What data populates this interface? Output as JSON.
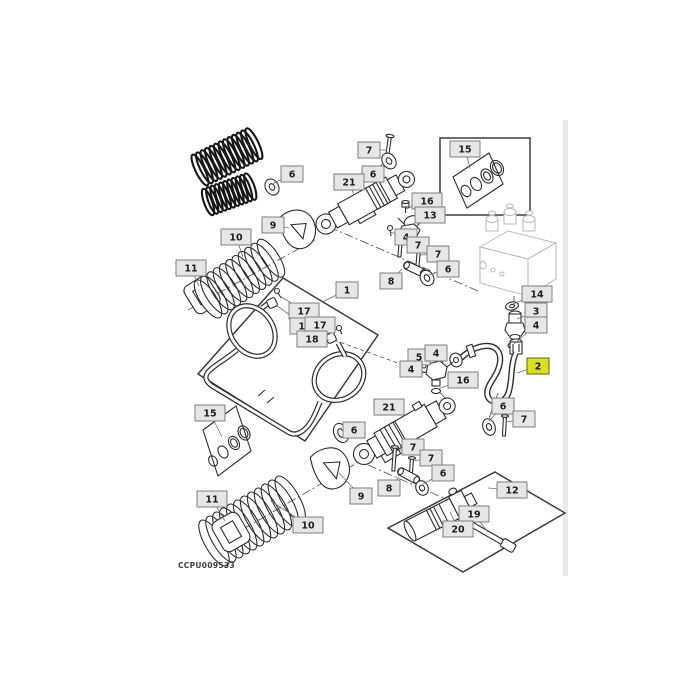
{
  "figure": {
    "caption": "CCPU009533",
    "selected_callout": "2",
    "label_fill": "#e6e6e6",
    "label_border": "#7f7f7f",
    "highlight_fill": "#d7e026",
    "highlight_border": "#5f6b00",
    "text_color": "#1d1d1d"
  },
  "callouts": [
    {
      "label": "7",
      "x": 358,
      "y": 142,
      "tx": 387,
      "ty": 150
    },
    {
      "label": "6",
      "x": 362,
      "y": 166,
      "tx": 383,
      "ty": 163
    },
    {
      "label": "21",
      "x": 334,
      "y": 174,
      "tx": 354,
      "ty": 195
    },
    {
      "label": "6",
      "x": 281,
      "y": 166,
      "tx": 272,
      "ty": 184
    },
    {
      "label": "9",
      "x": 262,
      "y": 217,
      "tx": 289,
      "ty": 228
    },
    {
      "label": "10",
      "x": 221,
      "y": 229,
      "tx": 243,
      "ty": 257
    },
    {
      "label": "11",
      "x": 176,
      "y": 260,
      "tx": 199,
      "ty": 286
    },
    {
      "label": "15",
      "x": 450,
      "y": 141,
      "tx": 470,
      "ty": 168
    },
    {
      "label": "16",
      "x": 412,
      "y": 193,
      "tx": 406,
      "ty": 209
    },
    {
      "label": "13",
      "x": 415,
      "y": 207,
      "tx": 417,
      "ty": 226
    },
    {
      "label": "4",
      "x": 395,
      "y": 229,
      "tx": 390,
      "ty": 232
    },
    {
      "label": "7",
      "x": 407,
      "y": 237,
      "tx": 401,
      "ty": 245
    },
    {
      "label": "7",
      "x": 427,
      "y": 246,
      "tx": 420,
      "ty": 255
    },
    {
      "label": "8",
      "x": 380,
      "y": 273,
      "tx": 402,
      "ty": 269
    },
    {
      "label": "6",
      "x": 437,
      "y": 261,
      "tx": 429,
      "ty": 275
    },
    {
      "label": "14",
      "x": 522,
      "y": 286,
      "tx": 513,
      "ty": 304
    },
    {
      "label": "3",
      "x": 525,
      "y": 303,
      "tx": 517,
      "ty": 319
    },
    {
      "label": "4",
      "x": 525,
      "y": 317,
      "tx": 514,
      "ty": 344
    },
    {
      "label": "2",
      "x": 527,
      "y": 358,
      "tx": 517,
      "ty": 373,
      "highlighted": true
    },
    {
      "label": "1",
      "x": 336,
      "y": 282,
      "tx": 322,
      "ty": 302
    },
    {
      "label": "17",
      "x": 289,
      "y": 303,
      "tx": 280,
      "ty": 296
    },
    {
      "label": "18",
      "x": 290,
      "y": 318,
      "tx": 276,
      "ty": 305
    },
    {
      "label": "17",
      "x": 305,
      "y": 317,
      "tx": 337,
      "ty": 330
    },
    {
      "label": "18",
      "x": 297,
      "y": 331,
      "tx": 329,
      "ty": 340
    },
    {
      "label": "15",
      "x": 195,
      "y": 405,
      "tx": 222,
      "ty": 437
    },
    {
      "label": "5",
      "x": 408,
      "y": 349,
      "tx": 427,
      "ty": 364
    },
    {
      "label": "4",
      "x": 425,
      "y": 345,
      "tx": 436,
      "ty": 355
    },
    {
      "label": "4",
      "x": 400,
      "y": 361,
      "tx": 420,
      "ty": 370
    },
    {
      "label": "16",
      "x": 448,
      "y": 372,
      "tx": 438,
      "ty": 389
    },
    {
      "label": "21",
      "x": 374,
      "y": 399,
      "tx": 396,
      "ty": 413
    },
    {
      "label": "6",
      "x": 492,
      "y": 398,
      "tx": 489,
      "ty": 421
    },
    {
      "label": "7",
      "x": 513,
      "y": 411,
      "tx": 506,
      "ty": 422
    },
    {
      "label": "6",
      "x": 343,
      "y": 422,
      "tx": 341,
      "ty": 430
    },
    {
      "label": "7",
      "x": 402,
      "y": 439,
      "tx": 396,
      "ty": 451
    },
    {
      "label": "7",
      "x": 420,
      "y": 450,
      "tx": 413,
      "ty": 461
    },
    {
      "label": "6",
      "x": 432,
      "y": 465,
      "tx": 423,
      "ty": 484
    },
    {
      "label": "8",
      "x": 378,
      "y": 480,
      "tx": 399,
      "ty": 477
    },
    {
      "label": "9",
      "x": 350,
      "y": 488,
      "tx": 339,
      "ty": 473
    },
    {
      "label": "10",
      "x": 293,
      "y": 517,
      "tx": 271,
      "ty": 501
    },
    {
      "label": "11",
      "x": 197,
      "y": 491,
      "tx": 225,
      "ty": 521
    },
    {
      "label": "12",
      "x": 497,
      "y": 482,
      "tx": 488,
      "ty": 488
    },
    {
      "label": "19",
      "x": 459,
      "y": 506,
      "tx": 488,
      "ty": 532
    },
    {
      "label": "20",
      "x": 443,
      "y": 521,
      "tx": 450,
      "ty": 512
    }
  ]
}
